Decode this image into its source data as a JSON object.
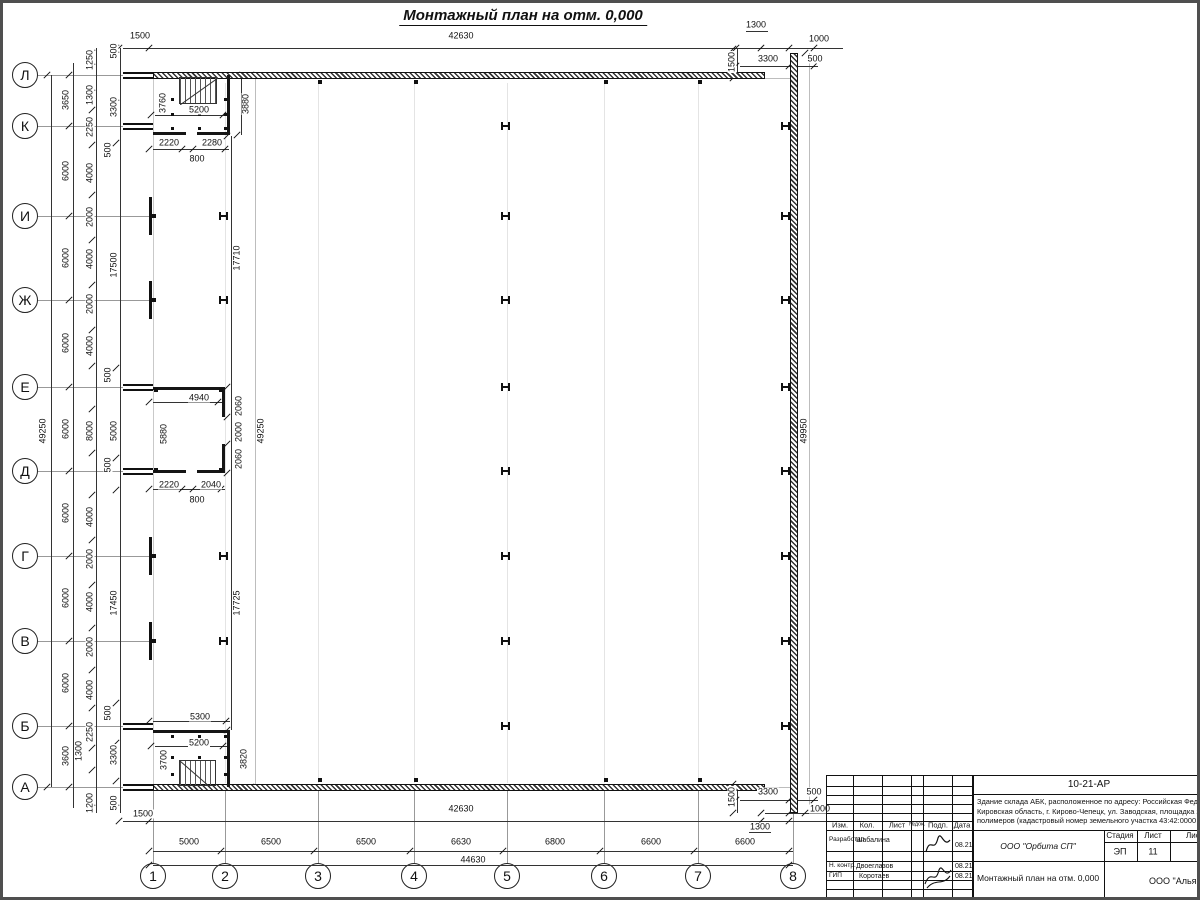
{
  "title": "Монтажный план на отм. 0,000",
  "axis_rows": [
    {
      "label": "Л",
      "y": 72
    },
    {
      "label": "К",
      "y": 123
    },
    {
      "label": "И",
      "y": 213
    },
    {
      "label": "Ж",
      "y": 297
    },
    {
      "label": "Е",
      "y": 384
    },
    {
      "label": "Д",
      "y": 468
    },
    {
      "label": "Г",
      "y": 553
    },
    {
      "label": "В",
      "y": 638
    },
    {
      "label": "Б",
      "y": 723
    },
    {
      "label": "А",
      "y": 784
    }
  ],
  "axis_cols": [
    {
      "label": "1",
      "x": 150
    },
    {
      "label": "2",
      "x": 222
    },
    {
      "label": "3",
      "x": 315
    },
    {
      "label": "4",
      "x": 411
    },
    {
      "label": "5",
      "x": 504
    },
    {
      "label": "6",
      "x": 601
    },
    {
      "label": "7",
      "x": 695
    },
    {
      "label": "8",
      "x": 790
    }
  ],
  "dim_labels": [
    {
      "t": "1500",
      "x": 137,
      "y": 33,
      "r": 0
    },
    {
      "t": "42630",
      "x": 458,
      "y": 33,
      "r": 0
    },
    {
      "t": "1300",
      "x": 753,
      "y": 22,
      "r": 0
    },
    {
      "t": "1000",
      "x": 816,
      "y": 36,
      "r": 0
    },
    {
      "t": "1500",
      "x": 729,
      "y": 59,
      "r": 1
    },
    {
      "t": "3300",
      "x": 765,
      "y": 56,
      "r": 0
    },
    {
      "t": "500",
      "x": 812,
      "y": 56,
      "r": 0
    },
    {
      "t": "3650",
      "x": 63,
      "y": 97,
      "r": 1
    },
    {
      "t": "6000",
      "x": 63,
      "y": 168,
      "r": 1
    },
    {
      "t": "6000",
      "x": 63,
      "y": 255,
      "r": 1
    },
    {
      "t": "6000",
      "x": 63,
      "y": 340,
      "r": 1
    },
    {
      "t": "6000",
      "x": 63,
      "y": 426,
      "r": 1
    },
    {
      "t": "6000",
      "x": 63,
      "y": 510,
      "r": 1
    },
    {
      "t": "6000",
      "x": 63,
      "y": 595,
      "r": 1
    },
    {
      "t": "6000",
      "x": 63,
      "y": 680,
      "r": 1
    },
    {
      "t": "3600",
      "x": 63,
      "y": 753,
      "r": 1
    },
    {
      "t": "49250",
      "x": 40,
      "y": 428,
      "r": 1
    },
    {
      "t": "1250",
      "x": 87,
      "y": 57,
      "r": 1
    },
    {
      "t": "1300",
      "x": 87,
      "y": 92,
      "r": 1
    },
    {
      "t": "2250",
      "x": 87,
      "y": 124,
      "r": 1
    },
    {
      "t": "4000",
      "x": 87,
      "y": 170,
      "r": 1
    },
    {
      "t": "2000",
      "x": 87,
      "y": 214,
      "r": 1
    },
    {
      "t": "4000",
      "x": 87,
      "y": 256,
      "r": 1
    },
    {
      "t": "2000",
      "x": 87,
      "y": 301,
      "r": 1
    },
    {
      "t": "4000",
      "x": 87,
      "y": 343,
      "r": 1
    },
    {
      "t": "8000",
      "x": 87,
      "y": 428,
      "r": 1
    },
    {
      "t": "4000",
      "x": 87,
      "y": 514,
      "r": 1
    },
    {
      "t": "2000",
      "x": 87,
      "y": 556,
      "r": 1
    },
    {
      "t": "4000",
      "x": 87,
      "y": 599,
      "r": 1
    },
    {
      "t": "2000",
      "x": 87,
      "y": 644,
      "r": 1
    },
    {
      "t": "4000",
      "x": 87,
      "y": 687,
      "r": 1
    },
    {
      "t": "2250",
      "x": 87,
      "y": 729,
      "r": 1
    },
    {
      "t": "1200",
      "x": 87,
      "y": 800,
      "r": 1
    },
    {
      "t": "1300",
      "x": 76,
      "y": 748,
      "r": 1
    },
    {
      "t": "500",
      "x": 105,
      "y": 147,
      "r": 1
    },
    {
      "t": "500",
      "x": 105,
      "y": 372,
      "r": 1
    },
    {
      "t": "500",
      "x": 105,
      "y": 462,
      "r": 1
    },
    {
      "t": "500",
      "x": 105,
      "y": 710,
      "r": 1
    },
    {
      "t": "500",
      "x": 111,
      "y": 48,
      "r": 1
    },
    {
      "t": "3300",
      "x": 111,
      "y": 104,
      "r": 1
    },
    {
      "t": "17500",
      "x": 111,
      "y": 262,
      "r": 1
    },
    {
      "t": "5000",
      "x": 111,
      "y": 428,
      "r": 1
    },
    {
      "t": "17450",
      "x": 111,
      "y": 600,
      "r": 1
    },
    {
      "t": "3300",
      "x": 111,
      "y": 752,
      "r": 1
    },
    {
      "t": "500",
      "x": 111,
      "y": 800,
      "r": 1
    },
    {
      "t": "3760",
      "x": 160,
      "y": 100,
      "r": 1
    },
    {
      "t": "5200",
      "x": 196,
      "y": 107,
      "r": 0
    },
    {
      "t": "3880",
      "x": 243,
      "y": 101,
      "r": 1
    },
    {
      "t": "2220",
      "x": 166,
      "y": 140,
      "r": 0
    },
    {
      "t": "2280",
      "x": 209,
      "y": 140,
      "r": 0
    },
    {
      "t": "800",
      "x": 194,
      "y": 156,
      "r": 0
    },
    {
      "t": "17710",
      "x": 234,
      "y": 255,
      "r": 1
    },
    {
      "t": "4940",
      "x": 196,
      "y": 395,
      "r": 0
    },
    {
      "t": "5880",
      "x": 161,
      "y": 431,
      "r": 1
    },
    {
      "t": "2060",
      "x": 236,
      "y": 403,
      "r": 1
    },
    {
      "t": "2000",
      "x": 236,
      "y": 429,
      "r": 1
    },
    {
      "t": "2060",
      "x": 236,
      "y": 456,
      "r": 1
    },
    {
      "t": "49250",
      "x": 258,
      "y": 428,
      "r": 1
    },
    {
      "t": "2220",
      "x": 166,
      "y": 482,
      "r": 0
    },
    {
      "t": "2040",
      "x": 208,
      "y": 482,
      "r": 0
    },
    {
      "t": "800",
      "x": 194,
      "y": 497,
      "r": 0
    },
    {
      "t": "17725",
      "x": 234,
      "y": 600,
      "r": 1
    },
    {
      "t": "5300",
      "x": 197,
      "y": 714,
      "r": 0
    },
    {
      "t": "5200",
      "x": 196,
      "y": 740,
      "r": 0
    },
    {
      "t": "3700",
      "x": 161,
      "y": 757,
      "r": 1
    },
    {
      "t": "3820",
      "x": 241,
      "y": 756,
      "r": 1
    },
    {
      "t": "49950",
      "x": 801,
      "y": 428,
      "r": 1
    },
    {
      "t": "1500",
      "x": 140,
      "y": 811,
      "r": 0
    },
    {
      "t": "42630",
      "x": 458,
      "y": 806,
      "r": 0
    },
    {
      "t": "1500",
      "x": 729,
      "y": 794,
      "r": 1
    },
    {
      "t": "3300",
      "x": 765,
      "y": 789,
      "r": 0
    },
    {
      "t": "500",
      "x": 811,
      "y": 789,
      "r": 0
    },
    {
      "t": "1000",
      "x": 817,
      "y": 806,
      "r": 0
    },
    {
      "t": "1300",
      "x": 757,
      "y": 824,
      "r": 0
    },
    {
      "t": "5000",
      "x": 186,
      "y": 839,
      "r": 0
    },
    {
      "t": "6500",
      "x": 268,
      "y": 839,
      "r": 0
    },
    {
      "t": "6500",
      "x": 363,
      "y": 839,
      "r": 0
    },
    {
      "t": "6630",
      "x": 458,
      "y": 839,
      "r": 0
    },
    {
      "t": "6800",
      "x": 552,
      "y": 839,
      "r": 0
    },
    {
      "t": "6600",
      "x": 648,
      "y": 839,
      "r": 0
    },
    {
      "t": "6600",
      "x": 742,
      "y": 839,
      "r": 0
    },
    {
      "t": "44630",
      "x": 470,
      "y": 857,
      "r": 0
    }
  ],
  "title_block": {
    "doc_number": "10-21-АР",
    "description_lines": [
      "Здание склада АБК, расположенное по адресу: Российская Феде",
      "Кировская область, г. Кирово-Чепецк, ул. Заводская, площадка з",
      "полимеров (кадастровый номер земельного участка 43:42:0000"
    ],
    "columns_header": [
      "Изм.",
      "Кол.",
      "Лист",
      "№док.",
      "Подп.",
      "Дата"
    ],
    "rows": [
      {
        "role": "Разработал",
        "name": "Шабалина",
        "date": "08.21"
      },
      {
        "role": "Н. контр.",
        "name": "Двоеглазов",
        "date": "08.21"
      },
      {
        "role": "ГИП",
        "name": "Коротаев",
        "date": "08.21"
      }
    ],
    "org": "ООО \"Орбита СП\"",
    "stage_header": [
      "Стадия",
      "Лист",
      "Листов"
    ],
    "stage_values": [
      "ЭП",
      "11",
      "1"
    ],
    "drawing_title": "Монтажный план на отм. 0,000",
    "org2": "ООО \"Альянс"
  }
}
